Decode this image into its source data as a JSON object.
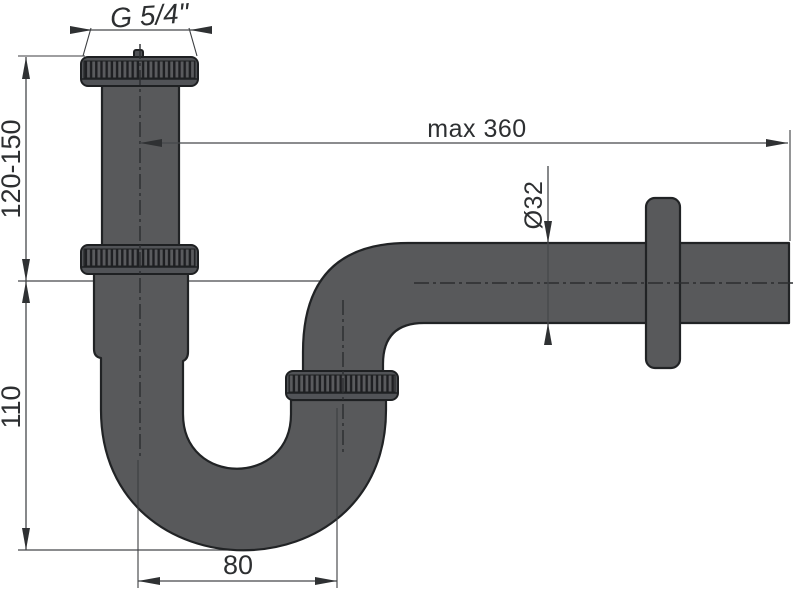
{
  "drawing": {
    "labels": {
      "thread_size": "G 5/4\"",
      "inlet_height_range": "120-150",
      "trap_depth": "110",
      "max_horizontal_reach": "max 360",
      "pipe_diameter": "Ø32",
      "limb_spacing": "80"
    },
    "colors": {
      "background": "#ffffff",
      "pipe_fill": "#58595b",
      "pipe_outline": "#212325",
      "nut_fill": "#515357",
      "knurl_ridge": "#1e1f22",
      "dimension_line": "#46484b",
      "label_text": "#2d2f31"
    }
  }
}
